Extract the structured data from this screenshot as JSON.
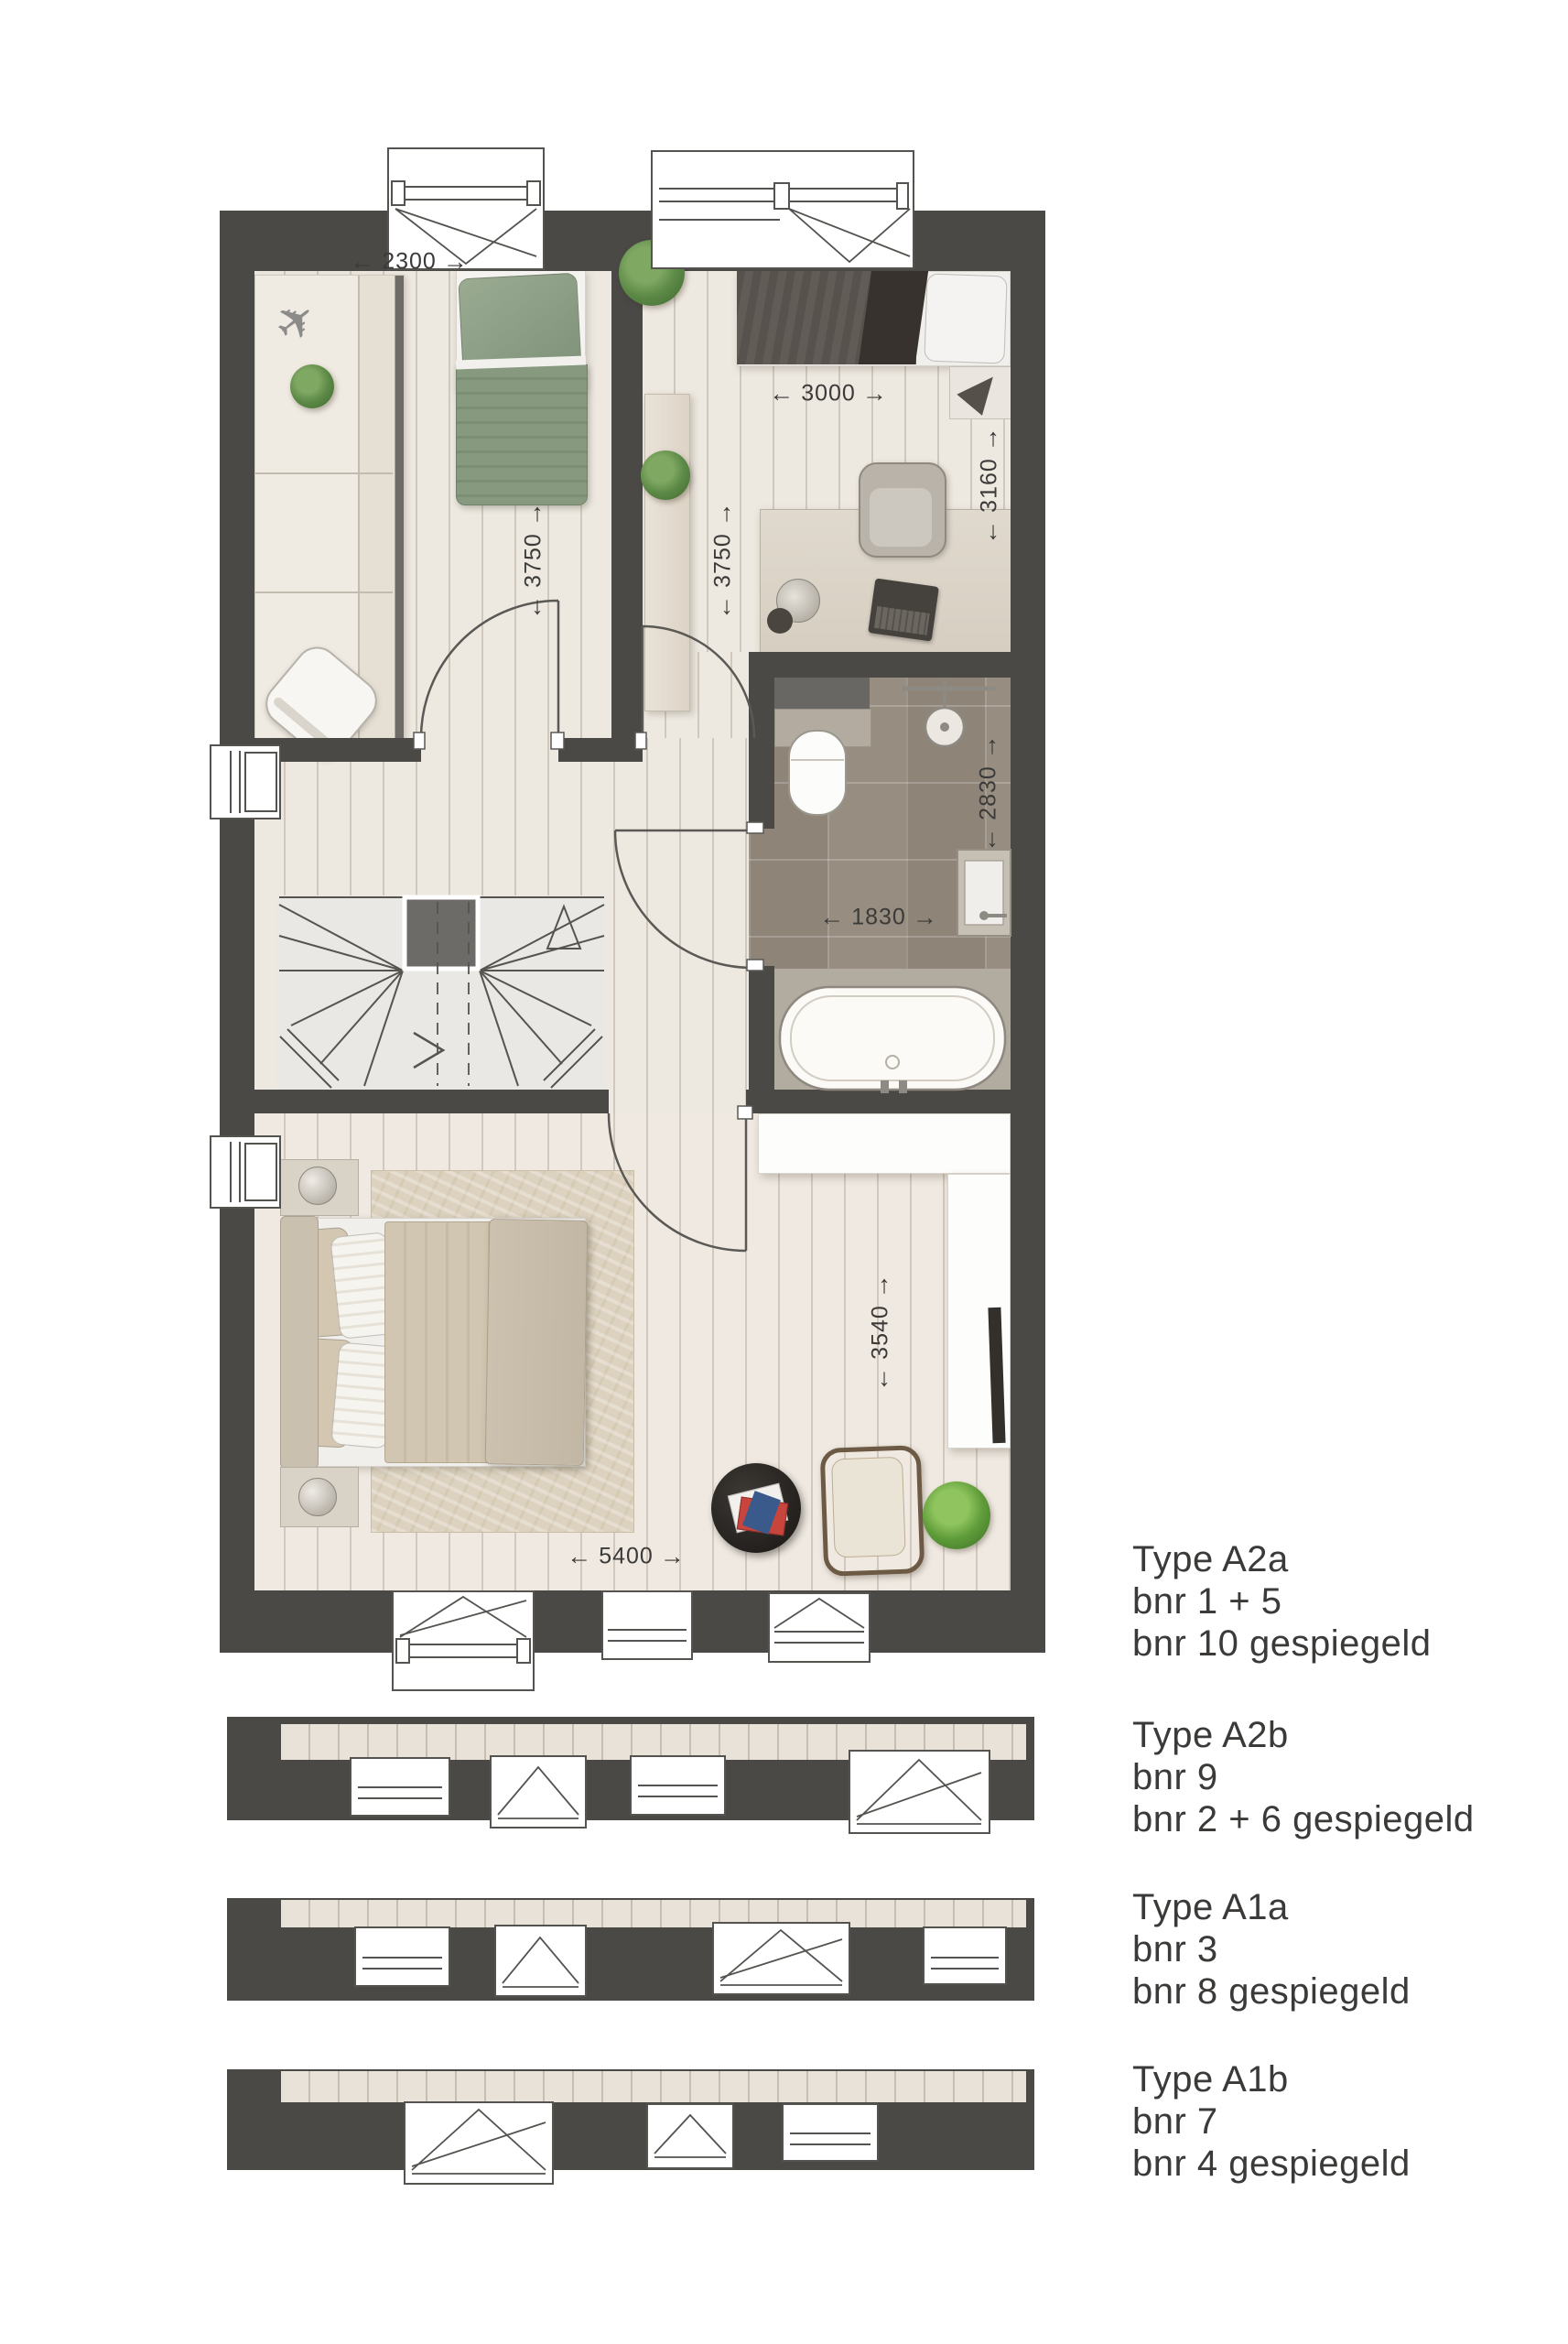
{
  "legend": {
    "blocks": [
      {
        "title": "Type A2a",
        "line2": "bnr 1 + 5",
        "line3": "bnr 10 gespiegeld"
      },
      {
        "title": "Type A2b",
        "line2": "bnr 9",
        "line3": "bnr 2 + 6 gespiegeld"
      },
      {
        "title": "Type A1a",
        "line2": "bnr 3",
        "line3": "bnr 8 gespiegeld"
      },
      {
        "title": "Type A1b",
        "line2": "bnr 7",
        "line3": "bnr 4 gespiegeld"
      }
    ]
  },
  "dimensions": {
    "bedroom_left_width": "2300",
    "bedroom_left_depth": "3750",
    "bedroom_right_width": "3000",
    "bedroom_right_depth": "3750",
    "bedroom_right_length": "3160",
    "bathroom_depth": "2830",
    "bathroom_width": "1830",
    "master_sitting_depth": "3540",
    "master_width": "5400"
  },
  "icons": {
    "arrow_left": "←",
    "arrow_right": "→",
    "airplane": "✈"
  },
  "colors": {
    "wall": "#4a4946",
    "wood_floor": "#ede8e0",
    "bathroom_tile": "#8e8578",
    "bed_green": "#84977c",
    "text": "#3b3a38"
  }
}
